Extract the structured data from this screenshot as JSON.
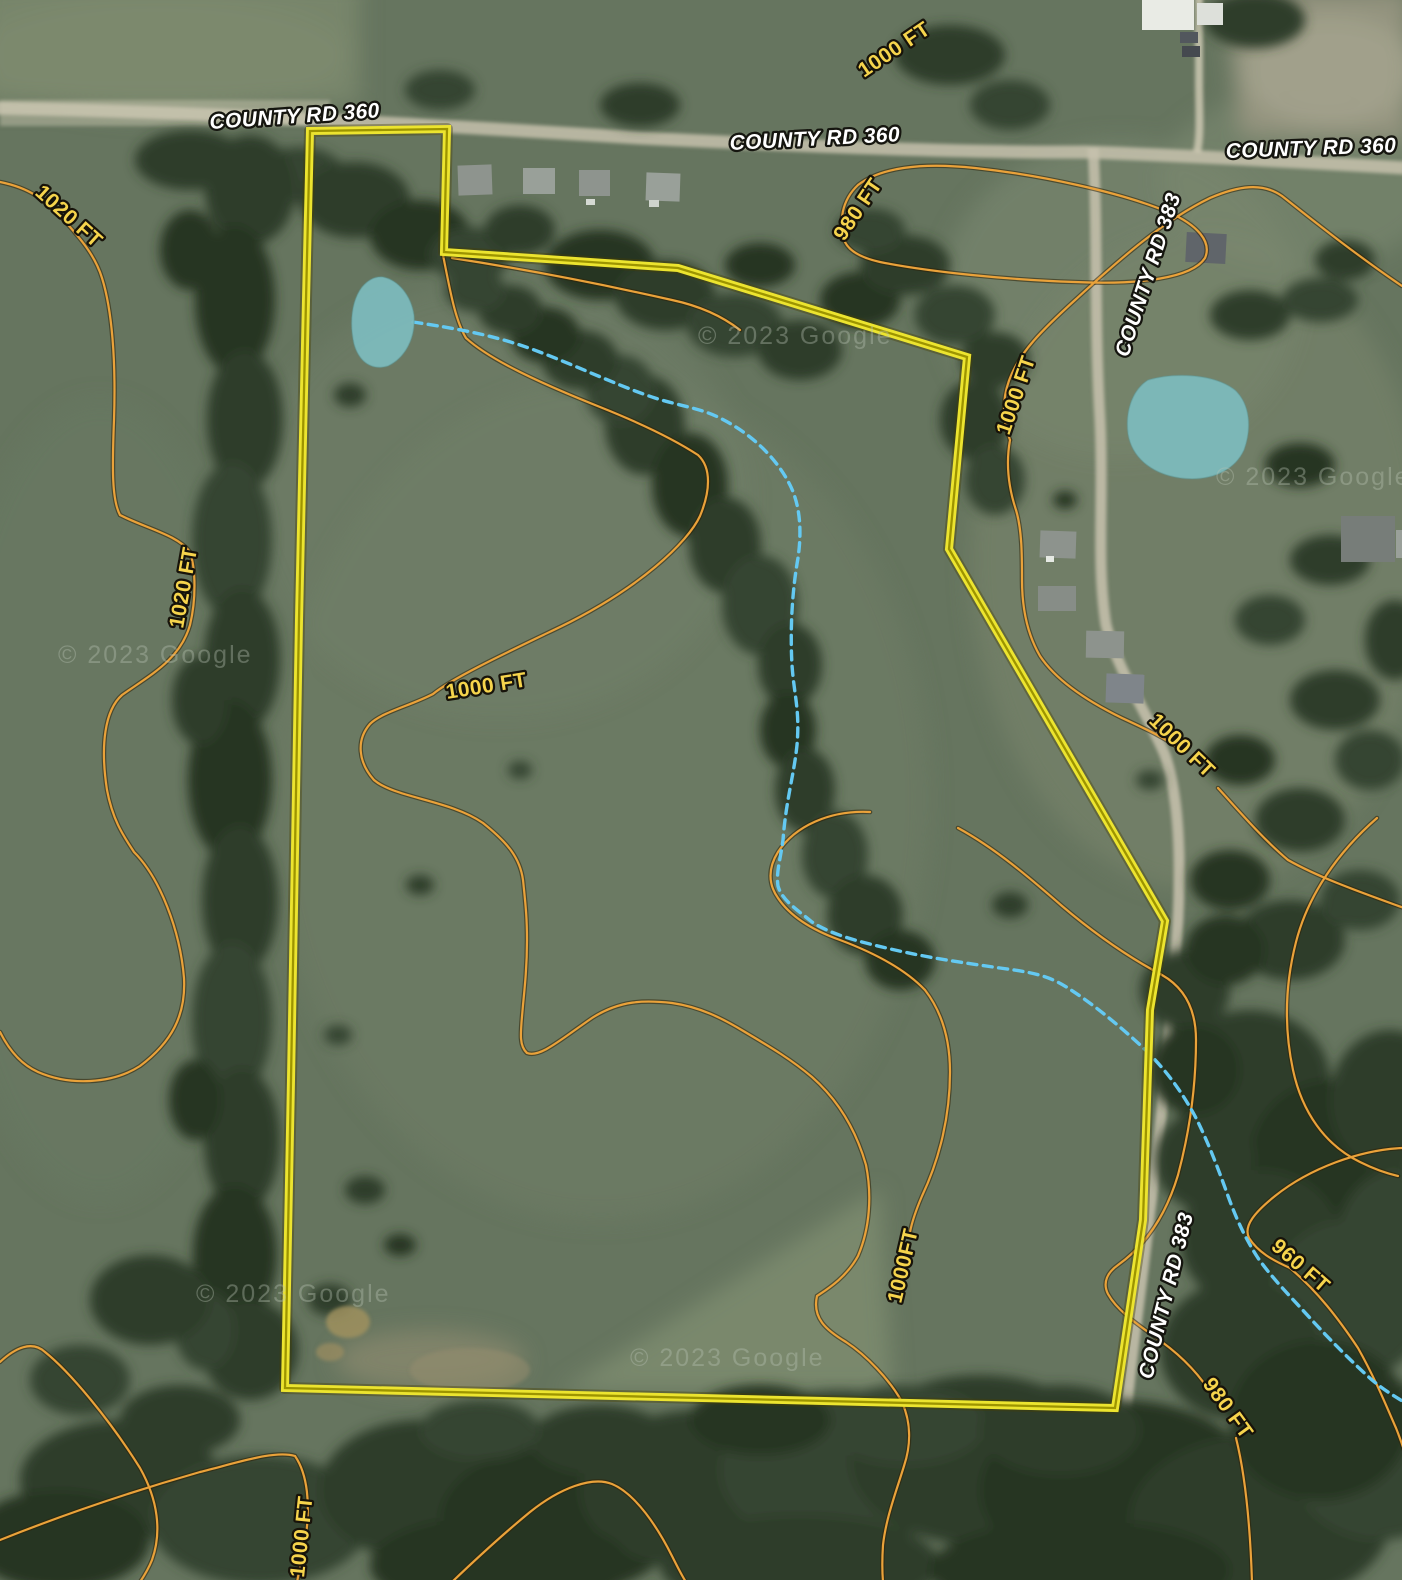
{
  "map": {
    "view_type": "satellite-with-topo-overlay",
    "imagery_attribution": "© 2023 Google",
    "watermark_text": "© 2023 Google",
    "colors": {
      "property_boundary": "#ece42f",
      "contour_line": "#eaa23a",
      "contour_label": "#f6d44c",
      "stream": "#64c9f2",
      "pond": "#7dbcbe",
      "road_label": "#ffffff"
    },
    "road_labels": [
      {
        "text": "COUNTY RD 360"
      },
      {
        "text": "COUNTY RD 360"
      },
      {
        "text": "COUNTY RD 360"
      },
      {
        "text": "COUNTY RD 383"
      },
      {
        "text": "COUNTY RD 383"
      }
    ],
    "contour_labels": [
      {
        "text": "1020 FT",
        "elevation_ft": 1020
      },
      {
        "text": "1020 FT",
        "elevation_ft": 1020
      },
      {
        "text": "1000 FT",
        "elevation_ft": 1000
      },
      {
        "text": "980 FT",
        "elevation_ft": 980
      },
      {
        "text": "1000 FT",
        "elevation_ft": 1000
      },
      {
        "text": "1000 FT",
        "elevation_ft": 1000
      },
      {
        "text": "1000 FT",
        "elevation_ft": 1000
      },
      {
        "text": "1000FT",
        "elevation_ft": 1000
      },
      {
        "text": "960 FT",
        "elevation_ft": 960
      },
      {
        "text": "980 FT",
        "elevation_ft": 980
      },
      {
        "text": "1000 FT",
        "elevation_ft": 1000
      }
    ],
    "water_features": {
      "ponds_count": 2,
      "stream_line_style": "dashed"
    }
  }
}
